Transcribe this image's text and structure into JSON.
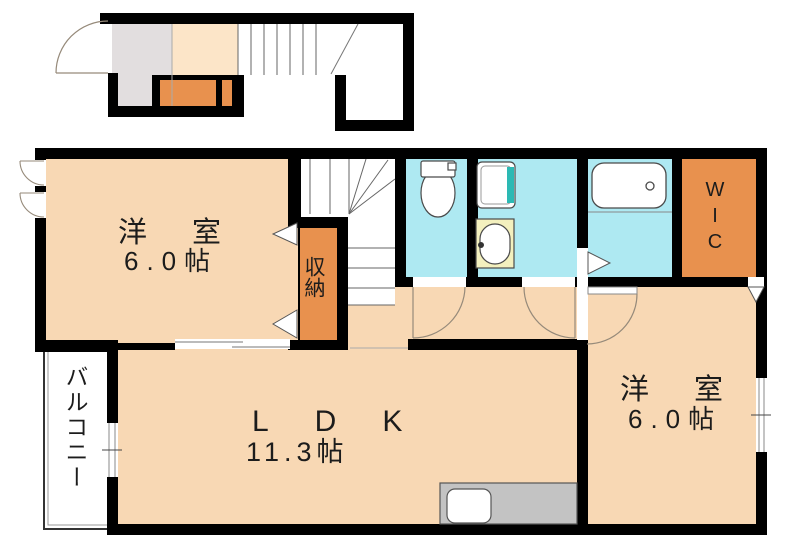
{
  "plan": {
    "rooms": {
      "bedroom_top": {
        "name": "洋室",
        "size": "6.0帖"
      },
      "bedroom_right": {
        "name": "洋室",
        "size": "6.0帖"
      },
      "ldk": {
        "name": "LDK",
        "size": "11.3帖"
      },
      "closet": {
        "name": "収納"
      },
      "walk_in_closet": {
        "name": "WIC"
      },
      "balcony": {
        "name": "バルコニー"
      }
    },
    "colors": {
      "wall": "#000000",
      "room_peach": "#F8D8B4",
      "entry_hall_peach": "#FCE5C8",
      "accent_orange": "#E8914E",
      "wet_area_blue": "#AEE9F2",
      "entry_gray": "#E2DEDF",
      "counter_gray": "#C3C3C3",
      "basin_yellow": "#F3F0BE",
      "washer_teal": "#2CB9B4"
    }
  }
}
